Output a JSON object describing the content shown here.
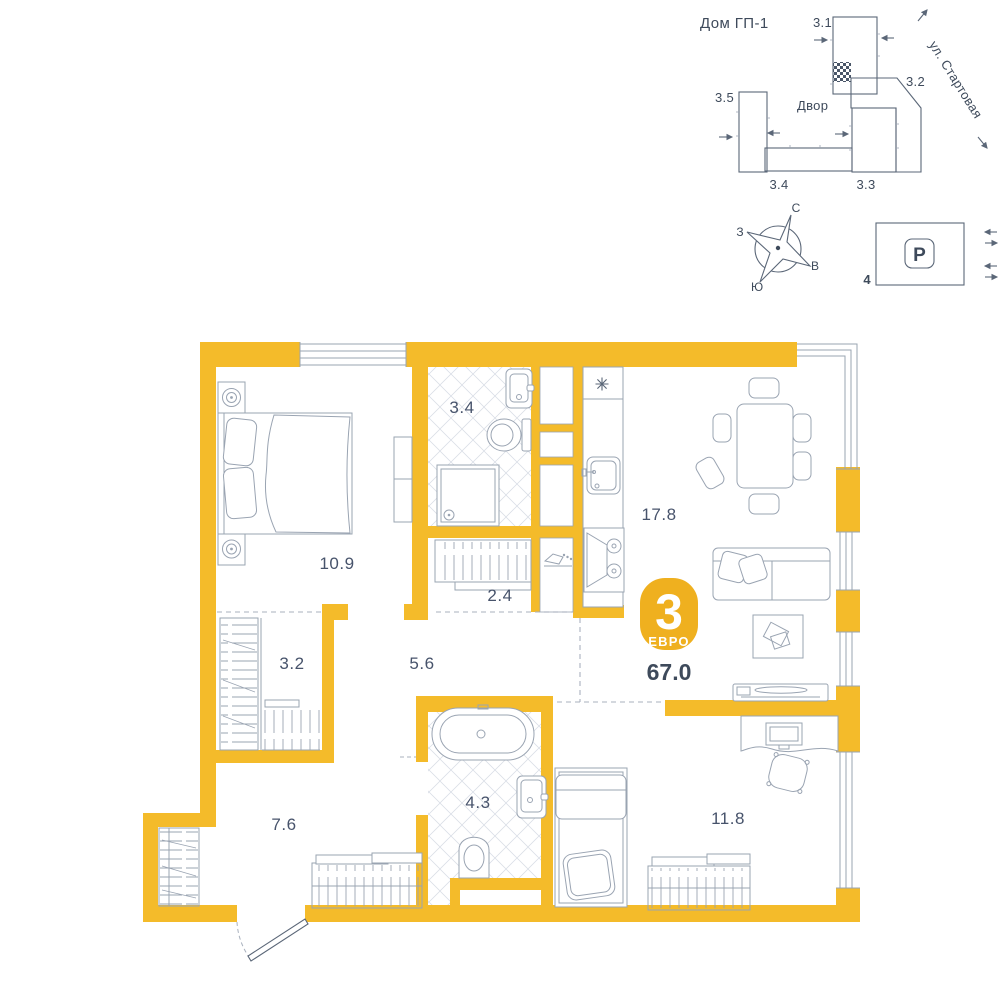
{
  "site_plan": {
    "title": "Дом ГП-1",
    "courtyard": "Двор",
    "street": "ул. Стартовая",
    "buildings": [
      {
        "label": "3.1"
      },
      {
        "label": "3.2"
      },
      {
        "label": "3.3"
      },
      {
        "label": "3.4"
      },
      {
        "label": "3.5"
      }
    ]
  },
  "compass": {
    "north": "С",
    "west": "З",
    "south": "Ю",
    "east": "В"
  },
  "parking": {
    "symbol": "P",
    "lot_number": "4"
  },
  "apartment": {
    "rooms_count": "3",
    "layout_type": "ЕВРО",
    "total_area": "67.0",
    "rooms": [
      {
        "id": "bedroom",
        "area": "10.9"
      },
      {
        "id": "bathroom",
        "area": "3.4"
      },
      {
        "id": "storage",
        "area": "2.4"
      },
      {
        "id": "kitchen-living",
        "area": "17.8"
      },
      {
        "id": "wardrobe",
        "area": "3.2"
      },
      {
        "id": "hallway",
        "area": "5.6"
      },
      {
        "id": "bathroom-2",
        "area": "4.3"
      },
      {
        "id": "entry-hall",
        "area": "7.6"
      },
      {
        "id": "bedroom-2",
        "area": "11.8"
      }
    ]
  },
  "colors": {
    "wall": "#F4BB2A",
    "badge": "#EFB01F",
    "line": "#9AA4B2",
    "line_dark": "#5B6778",
    "text": "#3E4A5B",
    "dash": "#A9B1BE",
    "tile": "#D9DEE6"
  }
}
